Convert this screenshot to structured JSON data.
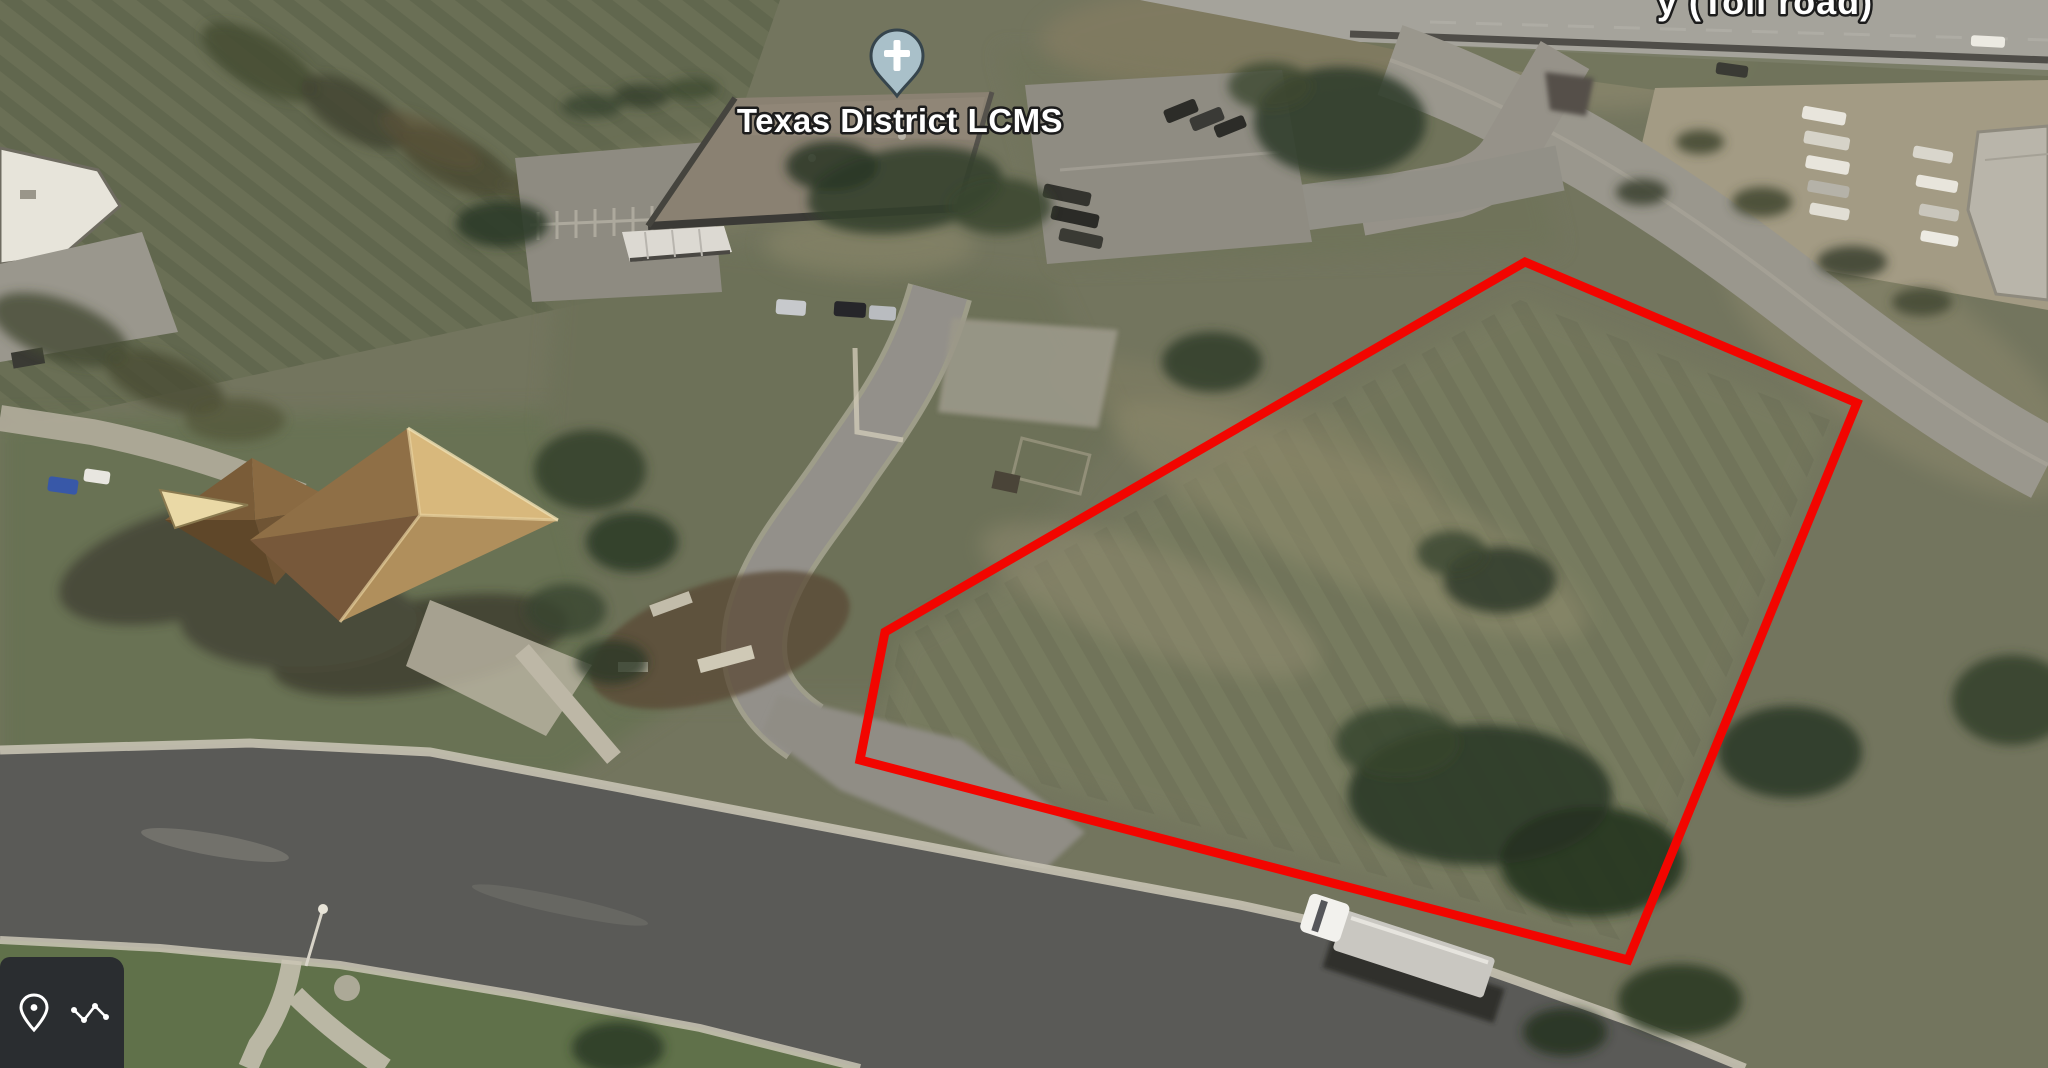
{
  "scene": {
    "type": "oblique-aerial-satellite-view",
    "description": "Aerial imagery of a vacant lot outlined in red beside the Texas District LCMS building"
  },
  "poi_label": {
    "text": "Texas District LCMS"
  },
  "partial_road_label": {
    "text": "y (Toll road)"
  },
  "marker": {
    "symbol": "cross",
    "fill": "#a9c0c9",
    "outline": "#36454d",
    "cross_color": "#ffffff"
  },
  "boundary": {
    "color": "#f20500",
    "stroke_width": "9",
    "points": "1525,262 1857,403 1628,960 860,760 885,632"
  },
  "toolbar": {
    "background": "#282b2f",
    "icons": [
      {
        "name": "location-pin-icon"
      },
      {
        "name": "measure-path-icon"
      }
    ]
  }
}
